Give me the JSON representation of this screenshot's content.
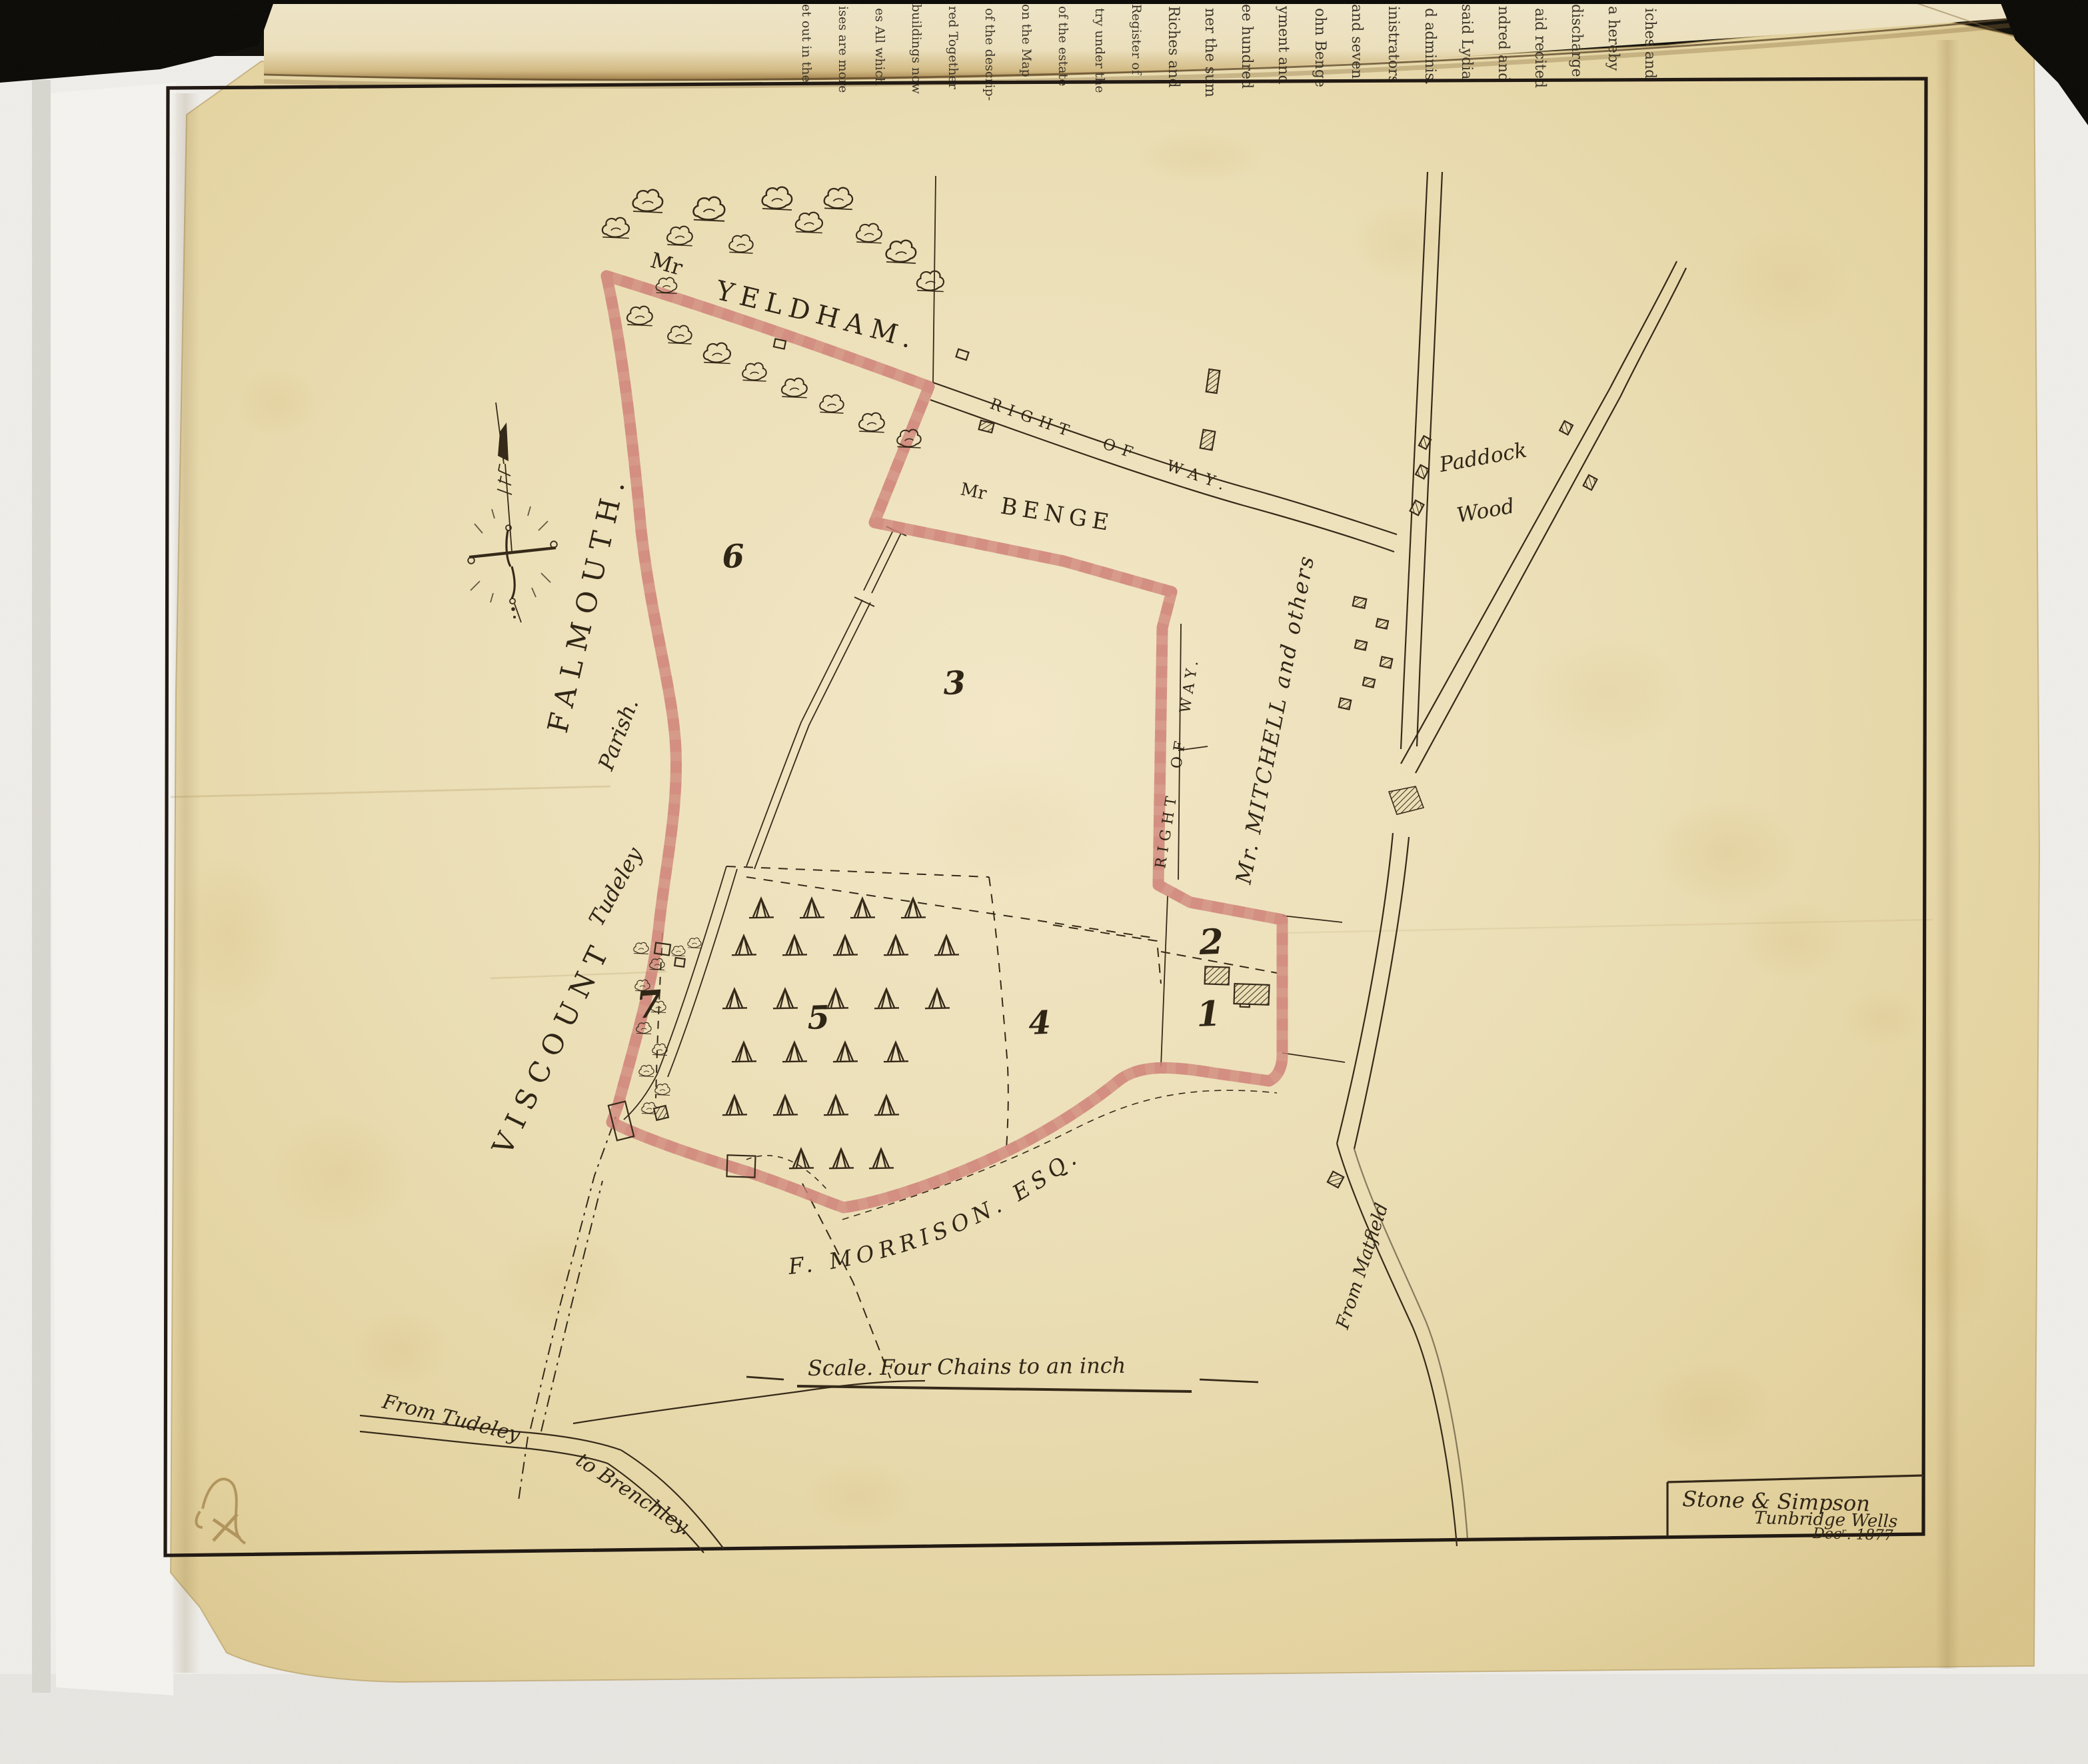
{
  "photo": {
    "book_page": {
      "fragments": [
        "et out in the",
        "ises are more",
        "es All which",
        "buildings now",
        "red Together",
        "of the descrip-",
        "on the Map",
        "of the estate",
        "try under the",
        "Register of",
        "Riches and",
        "ner the sum",
        "ee hundred",
        "yment and",
        "ohn Benge",
        "and seven",
        "inistrators",
        "d adminis.",
        "said Lydia",
        "ndred and",
        "aid recited",
        "discharge",
        "a hereby",
        "iches and"
      ]
    }
  },
  "map": {
    "labels": {
      "owner_north_prefix": "Mr",
      "owner_north": "YELDHAM.",
      "owner_benge_prefix": "Mr",
      "owner_benge": "BENGE",
      "right_of_way_top": "RIGHT OF WAY.",
      "right_of_way_east": "RIGHT OF WAY.",
      "paddock": "Paddock",
      "wood": "Wood",
      "owner_east": "Mr. MITCHELL and others",
      "owner_west_1": "VISCOUNT",
      "owner_west_2": "FALMOUTH.",
      "parish_1": "Tudeley",
      "parish_2": "Parish.",
      "owner_south": "F. MORRISON. ESQ.",
      "road_from_matfield": "From Matfield",
      "road_from_tudeley": "From Tudeley",
      "road_to_brenchley": "to Brenchley.",
      "scale_note": "Scale. Four Chains to an inch"
    },
    "parcels": [
      {
        "label": "1"
      },
      {
        "label": "2"
      },
      {
        "label": "3"
      },
      {
        "label": "4"
      },
      {
        "label": "5"
      },
      {
        "label": "6"
      },
      {
        "label": "7"
      }
    ],
    "cartouche": {
      "surveyor": "Stone & Simpson",
      "place": "Tunbridge Wells",
      "date": "Decʳ. 1877"
    },
    "colors": {
      "boundary_pink": "#e8a29a",
      "ink": "#342818",
      "paper": "#e9dbae"
    }
  }
}
